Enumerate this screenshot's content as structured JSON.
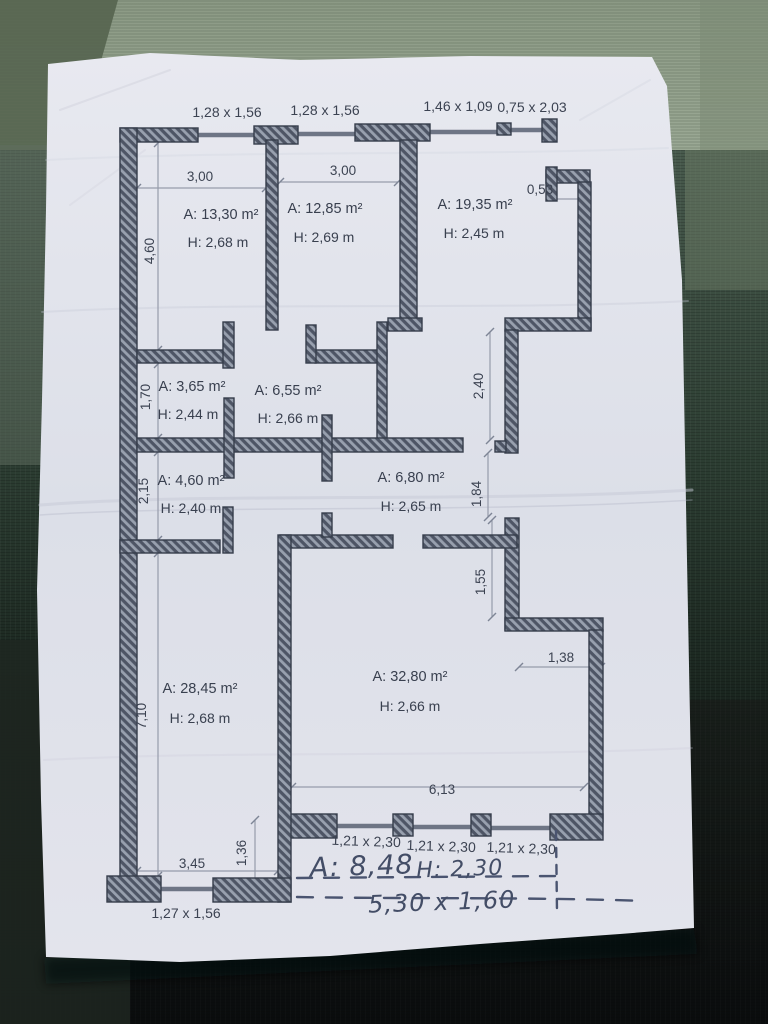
{
  "photo": {
    "description": "paper floor plan on dark green fabric",
    "colors": {
      "paper": "#e0e2ea",
      "wall": "#6d7585",
      "ink": "#39404f",
      "handwriting": "#434d66",
      "fabric": "#2c3b32"
    }
  },
  "plan": {
    "top_windows": [
      "1,28 x 1,56",
      "1,28 x 1,56",
      "1,46 x 1,09",
      "0,75 x 2,03"
    ],
    "rooms": [
      {
        "id": "room-top-left",
        "area": "A: 13,30 m²",
        "height": "H: 2,68 m"
      },
      {
        "id": "room-top-middle",
        "area": "A: 12,85 m²",
        "height": "H: 2,69 m"
      },
      {
        "id": "room-top-right",
        "area": "A: 19,35 m²",
        "height": "H: 2,45 m"
      },
      {
        "id": "room-small-left",
        "area": "A: 3,65 m²",
        "height": "H: 2,44 m"
      },
      {
        "id": "hallway-upper",
        "area": "A: 6,55 m²",
        "height": "H: 2,66 m"
      },
      {
        "id": "room-small-left-2",
        "area": "A: 4,60 m²",
        "height": "H: 2,40 m"
      },
      {
        "id": "hallway-lower",
        "area": "A: 6,80 m²",
        "height": "H: 2,65 m"
      },
      {
        "id": "room-bottom-left",
        "area": "A: 28,45 m²",
        "height": "H: 2,68 m"
      },
      {
        "id": "room-bottom-right",
        "area": "A: 32,80 m²",
        "height": "H: 2,66 m"
      }
    ],
    "dimensions": {
      "room1_width": "3,00",
      "room2_width": "3,00",
      "niche": "0,53",
      "left_top": "4,60",
      "left_mid1": "1,70",
      "left_mid2": "2,15",
      "left_bottom": "7,10",
      "right_top": "2,40",
      "right_mid1": "1,84",
      "right_mid2": "1,55",
      "step_width": "1,38",
      "big_room_width": "6,13",
      "bottom_left_width": "3,45",
      "bottom_gap": "1,36"
    },
    "bottom_windows": [
      "1,21 x 2,30",
      "1,21 x 2,30",
      "1,21 x 2,30"
    ],
    "bottom_left_window": "1,27 x 1,56",
    "balcony": {
      "area": "A: 8,48",
      "height": "H: 2,30",
      "size": "5,30 x 1,60"
    }
  }
}
